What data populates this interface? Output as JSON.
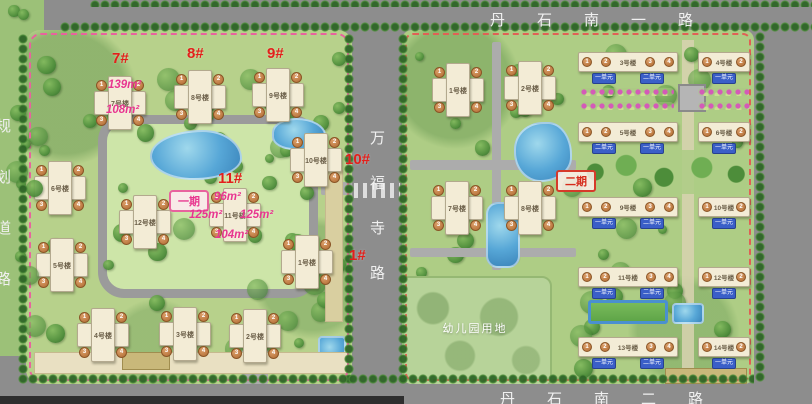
{
  "roads": {
    "top": "丹石南一路",
    "left": "规划道路",
    "middle": "万福寺路",
    "bottom": "丹石南二路"
  },
  "phases": {
    "phase1": "一期",
    "phase2": "二期"
  },
  "site": {
    "kindergarten_label": "幼儿园用地"
  },
  "annotations": [
    {
      "text": "7#",
      "x": 112,
      "y": 50,
      "type": "building-no"
    },
    {
      "text": "8#",
      "x": 187,
      "y": 45,
      "type": "building-no"
    },
    {
      "text": "9#",
      "x": 267,
      "y": 45,
      "type": "building-no"
    },
    {
      "text": "10#",
      "x": 345,
      "y": 151,
      "type": "building-no"
    },
    {
      "text": "11#",
      "x": 218,
      "y": 170,
      "type": "building-no"
    },
    {
      "text": "1#",
      "x": 349,
      "y": 247,
      "type": "building-no"
    },
    {
      "text": "139m²",
      "x": 108,
      "y": 79,
      "type": "area"
    },
    {
      "text": "108m²",
      "x": 106,
      "y": 104,
      "type": "area"
    },
    {
      "text": "96m²",
      "x": 214,
      "y": 191,
      "type": "area"
    },
    {
      "text": "125m²",
      "x": 189,
      "y": 209,
      "type": "area"
    },
    {
      "text": "125m²",
      "x": 240,
      "y": 209,
      "type": "area"
    },
    {
      "text": "104m²",
      "x": 215,
      "y": 229,
      "type": "area"
    }
  ],
  "phase1_buildings": [
    {
      "tag": "building-7",
      "name": "7号楼",
      "x": 94,
      "y": 73,
      "units": [
        "1",
        "2",
        "3",
        "4"
      ]
    },
    {
      "tag": "building-8",
      "name": "8号楼",
      "x": 174,
      "y": 67,
      "units": [
        "1",
        "2",
        "3",
        "4"
      ]
    },
    {
      "tag": "building-9",
      "name": "9号楼",
      "x": 252,
      "y": 65,
      "units": [
        "1",
        "2",
        "3",
        "4"
      ]
    },
    {
      "tag": "building-10",
      "name": "10号楼",
      "x": 290,
      "y": 130,
      "units": [
        "1",
        "2",
        "3",
        "4"
      ]
    },
    {
      "tag": "building-6",
      "name": "6号楼",
      "x": 34,
      "y": 158,
      "units": [
        "1",
        "2",
        "3",
        "4"
      ]
    },
    {
      "tag": "building-12",
      "name": "12号楼",
      "x": 119,
      "y": 192,
      "units": [
        "1",
        "2",
        "3",
        "4"
      ]
    },
    {
      "tag": "building-11",
      "name": "11号楼",
      "x": 209,
      "y": 185,
      "units": [
        "1",
        "2",
        "3",
        "4"
      ]
    },
    {
      "tag": "building-5",
      "name": "5号楼",
      "x": 36,
      "y": 235,
      "units": [
        "1",
        "2",
        "3",
        "4"
      ]
    },
    {
      "tag": "building-1",
      "name": "1号楼",
      "x": 281,
      "y": 232,
      "units": [
        "1",
        "2",
        "3",
        "4"
      ]
    },
    {
      "tag": "building-4",
      "name": "4号楼",
      "x": 77,
      "y": 305,
      "units": [
        "1",
        "2",
        "3",
        "4"
      ]
    },
    {
      "tag": "building-3",
      "name": "3号楼",
      "x": 159,
      "y": 304,
      "units": [
        "1",
        "2",
        "3",
        "4"
      ]
    },
    {
      "tag": "building-2",
      "name": "2号楼",
      "x": 229,
      "y": 306,
      "units": [
        "1",
        "2",
        "3",
        "4"
      ]
    }
  ],
  "phase2_cross_buildings": [
    {
      "tag": "building-1",
      "name": "1号楼",
      "x": 56,
      "y": 60,
      "units": [
        "1",
        "2",
        "3",
        "4"
      ]
    },
    {
      "tag": "building-2",
      "name": "2号楼",
      "x": 128,
      "y": 58,
      "units": [
        "1",
        "2",
        "3",
        "4"
      ]
    },
    {
      "tag": "building-7",
      "name": "7号楼",
      "x": 55,
      "y": 178,
      "units": [
        "1",
        "2",
        "3",
        "4"
      ]
    },
    {
      "tag": "building-8",
      "name": "8号楼",
      "x": 128,
      "y": 178,
      "units": [
        "1",
        "2",
        "3",
        "4"
      ]
    }
  ],
  "phase2_row_buildings": [
    {
      "tag": "building-3",
      "name": "3号楼",
      "x": 176,
      "y": 22,
      "w": 100,
      "units": [
        "1",
        "2",
        "3",
        "4"
      ],
      "unit_labels": [
        "一单元",
        "二单元"
      ]
    },
    {
      "tag": "building-4",
      "name": "4号楼",
      "x": 296,
      "y": 22,
      "w": 52,
      "units": [
        "1",
        "2"
      ],
      "unit_labels": [
        "一单元"
      ]
    },
    {
      "tag": "building-5",
      "name": "5号楼",
      "x": 176,
      "y": 92,
      "w": 100,
      "units": [
        "1",
        "2",
        "3",
        "4"
      ],
      "unit_labels": [
        "二单元",
        "一单元"
      ]
    },
    {
      "tag": "building-6",
      "name": "6号楼",
      "x": 296,
      "y": 92,
      "w": 52,
      "units": [
        "1",
        "2"
      ],
      "unit_labels": [
        "一单元"
      ]
    },
    {
      "tag": "building-9",
      "name": "9号楼",
      "x": 176,
      "y": 167,
      "w": 100,
      "units": [
        "1",
        "2",
        "3",
        "4"
      ],
      "unit_labels": [
        "一单元",
        "二单元"
      ]
    },
    {
      "tag": "building-10",
      "name": "10号楼",
      "x": 296,
      "y": 167,
      "w": 52,
      "units": [
        "1",
        "2"
      ],
      "unit_labels": [
        "一单元"
      ]
    },
    {
      "tag": "building-11",
      "name": "11号楼",
      "x": 176,
      "y": 237,
      "w": 100,
      "units": [
        "1",
        "2",
        "3",
        "4"
      ],
      "unit_labels": [
        "一单元",
        "二单元"
      ]
    },
    {
      "tag": "building-12",
      "name": "12号楼",
      "x": 296,
      "y": 237,
      "w": 52,
      "units": [
        "1",
        "2"
      ],
      "unit_labels": [
        "一单元"
      ]
    },
    {
      "tag": "building-13",
      "name": "13号楼",
      "x": 176,
      "y": 307,
      "w": 100,
      "units": [
        "1",
        "2",
        "3",
        "4"
      ],
      "unit_labels": [
        "一单元",
        "二单元"
      ]
    },
    {
      "tag": "building-14",
      "name": "14号楼",
      "x": 296,
      "y": 307,
      "w": 52,
      "units": [
        "1",
        "2"
      ],
      "unit_labels": [
        "一单元"
      ]
    }
  ],
  "colors": {
    "road_gray": "#8d8d8d",
    "building_number_red": "#e3201b",
    "area_label_magenta": "#e8368f",
    "unit_tag_blue": "#3a5fc8",
    "building_cream": "#f3ecd6",
    "water_blue": "#57a7d7",
    "phase1_pink": "#e8629e",
    "phase2_red": "#d63a2a",
    "lawn_green": "#b7d18b"
  }
}
